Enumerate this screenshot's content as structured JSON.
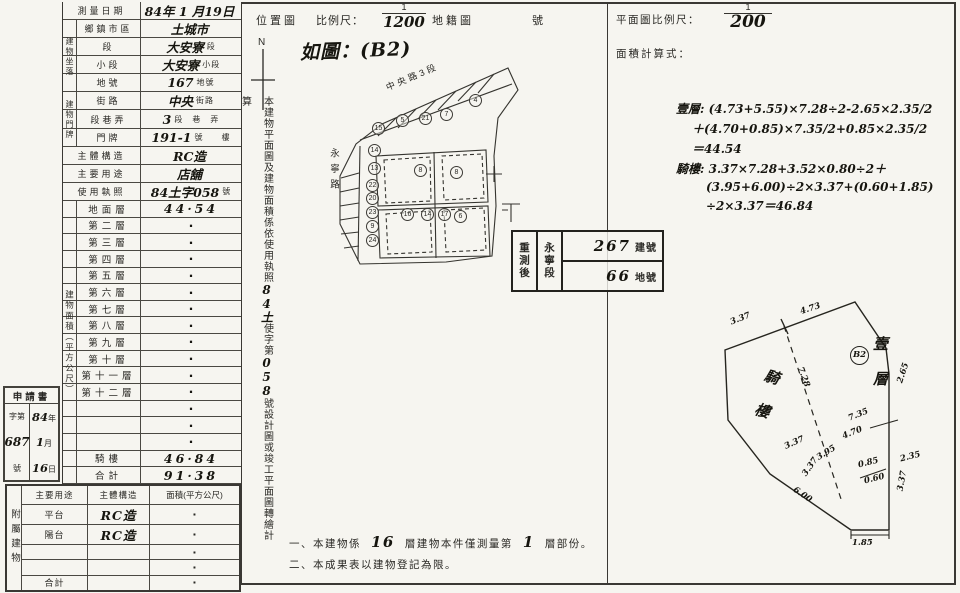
{
  "colors": {
    "paper": "#f6f5f0",
    "ink": "#2a2925",
    "hand": "#16150f"
  },
  "main_table": {
    "top_rows": [
      {
        "label": "測量日期",
        "value": "84年 1 月19日",
        "suffix": "",
        "cls": "full"
      },
      {
        "label": "鄉鎮市區",
        "value": "土城市",
        "suffix": "",
        "cls": "grouped"
      },
      {
        "label": "段",
        "value": "大安寮",
        "suffix": "段",
        "cls": "grouped"
      },
      {
        "label": "小段",
        "value": "大安寮",
        "suffix": "小段",
        "cls": "grouped"
      },
      {
        "label": "地號",
        "value": "167",
        "suffix": "地號",
        "cls": "grouped"
      },
      {
        "label": "街路",
        "value": "中央",
        "suffix": "街路",
        "cls": "grouped"
      },
      {
        "label": "段巷弄",
        "value": "3",
        "suffix": "段　巷　弄",
        "cls": "grouped"
      },
      {
        "label": "門牌",
        "value": "191-1",
        "suffix": "號　　樓",
        "cls": "grouped"
      },
      {
        "label": "主體構造",
        "value": "RC造",
        "suffix": "",
        "cls": "full"
      },
      {
        "label": "主要用途",
        "value": "店舖",
        "suffix": "",
        "cls": "full"
      },
      {
        "label": "使用執照",
        "value": "84土字058",
        "suffix": "號",
        "cls": "full"
      }
    ],
    "group_labels": {
      "zuoluo": "建物坐落",
      "menpai": "建物門牌",
      "mianji": "建物面積（平方公尺）"
    },
    "area_rows": [
      {
        "label": "地面層",
        "value": "44·54",
        "vcls": "hwv"
      },
      {
        "label": "第二層",
        "value": "·",
        "vcls": "dot"
      },
      {
        "label": "第三層",
        "value": "·",
        "vcls": "dot"
      },
      {
        "label": "第四層",
        "value": "·",
        "vcls": "dot"
      },
      {
        "label": "第五層",
        "value": "·",
        "vcls": "dot"
      },
      {
        "label": "第六層",
        "value": "·",
        "vcls": "dot"
      },
      {
        "label": "第七層",
        "value": "·",
        "vcls": "dot"
      },
      {
        "label": "第八層",
        "value": "·",
        "vcls": "dot"
      },
      {
        "label": "第九層",
        "value": "·",
        "vcls": "dot"
      },
      {
        "label": "第十層",
        "value": "·",
        "vcls": "dot"
      },
      {
        "label": "第十一層",
        "value": "·",
        "vcls": "dot"
      },
      {
        "label": "第十二層",
        "value": "·",
        "vcls": "dot"
      },
      {
        "label": "",
        "value": "·",
        "vcls": "dot"
      },
      {
        "label": "",
        "value": "·",
        "vcls": "dot"
      },
      {
        "label": "",
        "value": "·",
        "vcls": "dot"
      },
      {
        "label": "騎樓",
        "value": "46·84",
        "vcls": "hwv"
      },
      {
        "label": "合計",
        "value": "91·38",
        "vcls": "hwv"
      }
    ]
  },
  "attach_table": {
    "side": "附屬建物",
    "h1": "主要用途",
    "h2": "主體構造",
    "h3": "面積(平方公尺)",
    "rows": [
      {
        "c1": "平台",
        "c2": "RC造",
        "c3": "·"
      },
      {
        "c1": "陽台",
        "c2": "RC造",
        "c3": "·"
      },
      {
        "c1": "",
        "c2": "",
        "c3": "·"
      },
      {
        "c1": "",
        "c2": "",
        "c3": "·"
      },
      {
        "c1": "合計",
        "c2": "",
        "c3": "·"
      }
    ]
  },
  "app_stamp": {
    "title": "申請書",
    "prefix": "字第",
    "number": "687",
    "suffix": "號",
    "year": "84",
    "year_u": "年",
    "month": "1",
    "month_u": "月",
    "day": "16",
    "day_u": "日"
  },
  "middle": {
    "statement": {
      "p1": "本建物平面圖及建物面積係依使用執照",
      "h1": "84土",
      "p2": "使字第",
      "h2": "058",
      "p3": "號設計圖或竣工平面圖轉繪計算"
    },
    "header": {
      "title": "位置圖",
      "scale": "比例尺：",
      "num": "1",
      "den": "1200",
      "map": "地籍圖",
      "no": "號"
    },
    "annotation": "如圖：(B2)",
    "north": "N",
    "streets": {
      "top": "中央路3段",
      "left": "永寧路"
    },
    "lots": [
      {
        "n": "15",
        "style": "left:46px;top:66px"
      },
      {
        "n": "5",
        "style": "left:70px;top:58px"
      },
      {
        "n": "21",
        "style": "left:93px;top:56px"
      },
      {
        "n": "7",
        "style": "left:114px;top:52px"
      },
      {
        "n": "4",
        "style": "left:143px;top:38px"
      },
      {
        "n": "14",
        "style": "left:42px;top:88px"
      },
      {
        "n": "13",
        "style": "left:42px;top:106px"
      },
      {
        "n": "22",
        "style": "left:40px;top:123px"
      },
      {
        "n": "20",
        "style": "left:40px;top:136px"
      },
      {
        "n": "23",
        "style": "left:40px;top:150px"
      },
      {
        "n": "9",
        "style": "left:40px;top:164px"
      },
      {
        "n": "24",
        "style": "left:40px;top:178px"
      },
      {
        "n": "8",
        "style": "left:88px;top:108px"
      },
      {
        "n": "8",
        "style": "left:124px;top:110px"
      },
      {
        "n": "16",
        "style": "left:75px;top:152px"
      },
      {
        "n": "14",
        "style": "left:95px;top:152px"
      },
      {
        "n": "17",
        "style": "left:112px;top:152px"
      },
      {
        "n": "6",
        "style": "left:128px;top:154px"
      }
    ],
    "restamp": {
      "title": "重測後",
      "seg": "永寧段",
      "building_no": "267",
      "building_u": "建號",
      "land_no": "66",
      "land_u": "地號"
    },
    "notes": {
      "n1a": "一、本建物係",
      "n1h1": "16",
      "n1b": "層建物本件僅測量第",
      "n1h2": "1",
      "n1c": "層部份。",
      "n2": "二、本成果表以建物登記為限。"
    }
  },
  "right": {
    "header": {
      "label": "平面圖比例尺：",
      "num": "1",
      "den": "200"
    },
    "calc_label": "面積計算式：",
    "calc": [
      {
        "t": "壹層: (4.73+5.55)×7.28÷2-2.65×2.35/2",
        "style": ""
      },
      {
        "t": "＋(4.70+0.85)×7.35/2+0.85×2.35/2",
        "style": "margin-left:16px"
      },
      {
        "t": "＝44.54",
        "style": "margin-left:16px"
      },
      {
        "t": "騎樓: 3.37×7.28+3.52×0.80÷2＋",
        "style": ""
      },
      {
        "t": "(3.95+6.00)÷2×3.37+(0.60+1.85)",
        "style": "margin-left:30px"
      },
      {
        "t": "÷2×3.37＝46.84",
        "style": "margin-left:30px"
      }
    ],
    "plot": {
      "first": "壹層",
      "arcade": "騎樓",
      "b2": "B2",
      "dims": [
        {
          "v": "3.37",
          "style": "left:30px;top:22px;transform:rotate(-21deg)"
        },
        {
          "v": "4.73",
          "style": "left:100px;top:12px;transform:rotate(-18deg)"
        },
        {
          "v": "7.28",
          "style": "left:93px;top:80px;transform:rotate(70deg)"
        },
        {
          "v": "2.65",
          "style": "left:193px;top:76px;transform:rotate(-72deg)"
        },
        {
          "v": "7.35",
          "style": "left:148px;top:118px;transform:rotate(-22deg)"
        },
        {
          "v": "4.70",
          "style": "left:142px;top:136px;transform:rotate(-22deg)"
        },
        {
          "v": "3.95",
          "style": "left:116px;top:156px;transform:rotate(-32deg)"
        },
        {
          "v": "3.37",
          "style": "left:84px;top:146px;transform:rotate(-24deg)"
        },
        {
          "v": "3.37",
          "style": "left:100px;top:170px;transform:rotate(-55deg)"
        },
        {
          "v": "0.85",
          "style": "left:158px;top:166px;transform:rotate(-14deg)"
        },
        {
          "v": "0.60",
          "style": "left:164px;top:182px;transform:rotate(-14deg)"
        },
        {
          "v": "2.35",
          "style": "left:200px;top:160px;transform:rotate(-14deg)"
        },
        {
          "v": "6.00",
          "style": "left:92px;top:198px;transform:rotate(34deg)"
        },
        {
          "v": "1.85",
          "style": "left:152px;top:246px"
        },
        {
          "v": "3.37",
          "style": "left:192px;top:184px;transform:rotate(-80deg)"
        }
      ]
    }
  }
}
